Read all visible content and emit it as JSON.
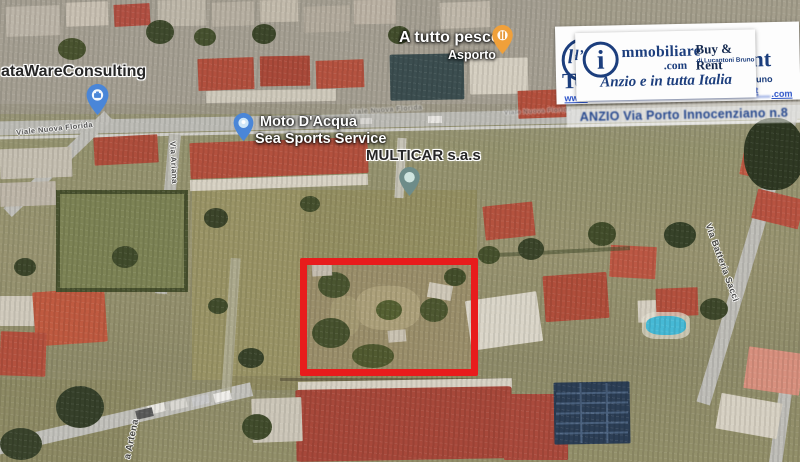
{
  "map": {
    "pois": {
      "restaurant": {
        "name": "A tutto pesce",
        "subtitle": "Asporto"
      },
      "consulting": {
        "name": "ataWareConsulting"
      },
      "watersports": {
        "line1": "Moto D'Acqua",
        "line2": "Sea Sports Service"
      },
      "car_dealer": {
        "name": "MULTICAR s.a.s"
      }
    },
    "streets": {
      "top_road": "Viale Nuova Florida",
      "left_vertical": "Via Ariana",
      "bottom_left": "a Artena",
      "right_vertical": "Via Batteria Sacci"
    }
  },
  "overlay": {
    "back_card": {
      "fragment_left": "Te",
      "fragment_right": "ent",
      "owner_fragment": "Bruno",
      "net_fragment": ".net",
      "url_prefix": "www.",
      "url_suffix": ".com"
    },
    "front_card": {
      "logo_script": "l’",
      "logo_letter": "i",
      "brand": "mmobiliare",
      "brand_tld": ".com",
      "buy_rent": "Buy & Rent",
      "owner": "di Lucantoni Bruno",
      "tagline": "Anzio e in tutta Italia"
    },
    "address": "ANZIO Via Porto Innocenziano n.8"
  },
  "annotation": {
    "highlight_color": "#e81c1c"
  },
  "colors": {
    "brand_navy": "#1c3e7d",
    "link_blue": "#2a52c8",
    "pin_orange": "#f0a03a",
    "pin_blue": "#4a86d8",
    "pin_teal": "#6e8c89"
  }
}
